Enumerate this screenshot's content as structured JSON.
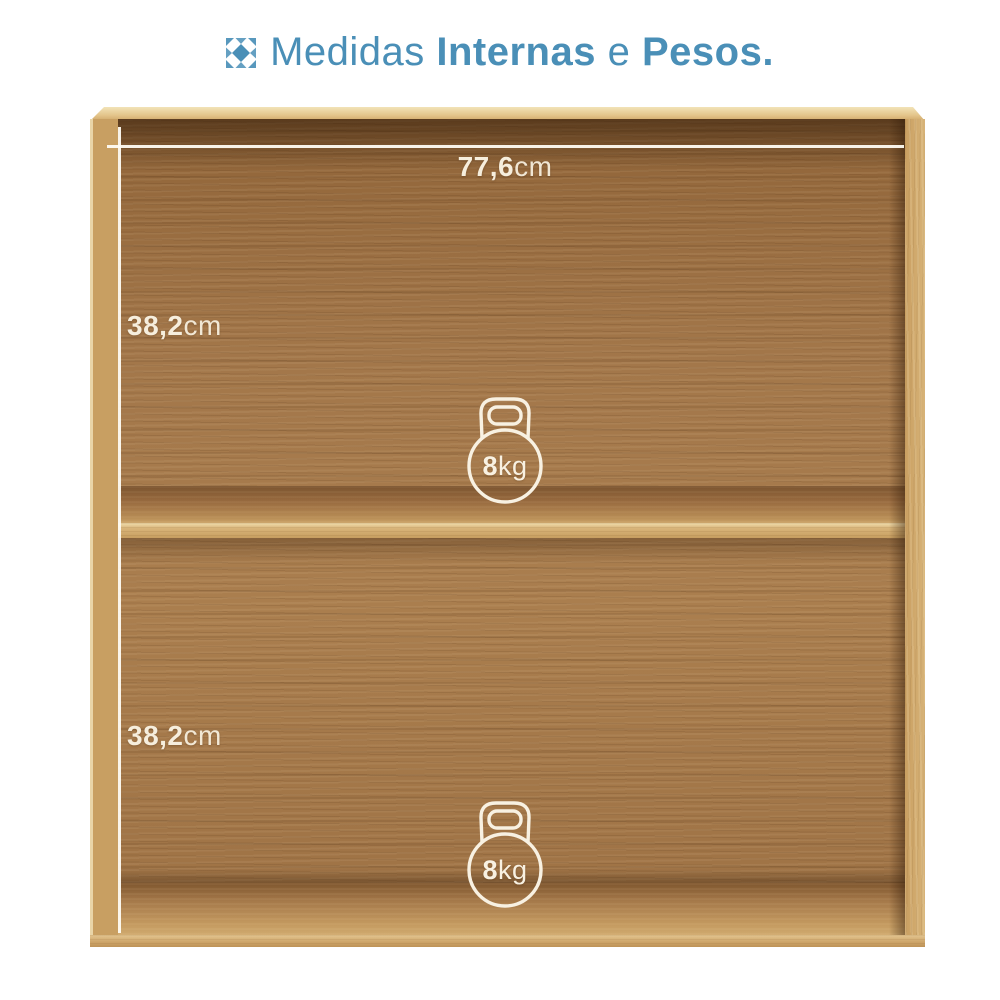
{
  "title": {
    "word1": "Medidas ",
    "word2": "Internas",
    "word3": " e ",
    "word4": "Pesos."
  },
  "measurements": {
    "width": {
      "value": "77,6",
      "unit": "cm"
    },
    "top_compartment_height": {
      "value": "38,2",
      "unit": "cm"
    },
    "bottom_compartment_height": {
      "value": "38,2",
      "unit": "cm"
    }
  },
  "weights": {
    "top_compartment": {
      "value": "8",
      "unit": "kg"
    },
    "bottom_compartment": {
      "value": "8",
      "unit": "kg"
    }
  },
  "icons": {
    "title_icon": "mosaic-tile-icon",
    "weight_icon": "kettlebell-icon"
  },
  "colors": {
    "accent_blue": "#4a8fb7",
    "label_cream": "#f6eedd",
    "frame_wood_light": "#d2ad72",
    "panel_wood_dark": "#a3774a",
    "background": "#ffffff"
  }
}
